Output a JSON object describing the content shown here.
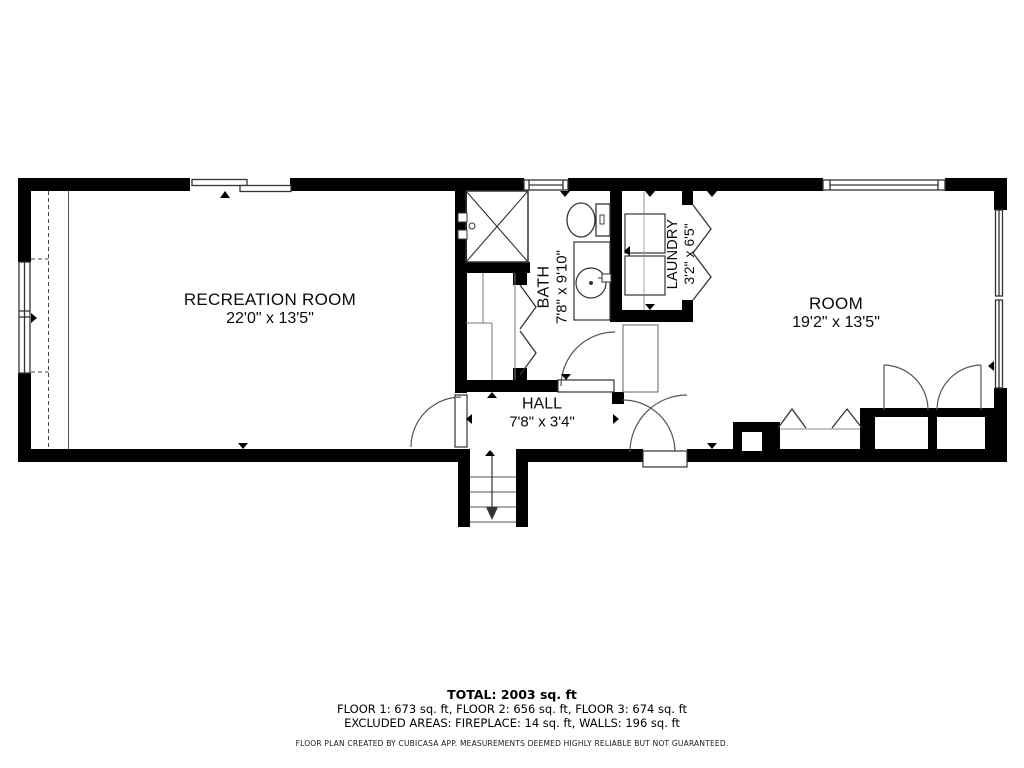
{
  "plan": {
    "rooms": [
      {
        "id": "recreation_room",
        "name": "RECREATION ROOM",
        "dims": "22'0\" x 13'5\""
      },
      {
        "id": "bath",
        "name": "BATH",
        "dims": "7'8\" x 9'10\""
      },
      {
        "id": "laundry",
        "name": "LAUNDRY",
        "dims": "3'2\" x 6'5\""
      },
      {
        "id": "room",
        "name": "ROOM",
        "dims": "19'2\" x 13'5\""
      },
      {
        "id": "hall",
        "name": "HALL",
        "dims": "7'8\" x 3'4\""
      }
    ],
    "features": [
      "stairs-down",
      "shower",
      "toilet",
      "sink-vanity",
      "washer",
      "dryer",
      "fireplace",
      "closets",
      "windows"
    ]
  },
  "summary": {
    "total": "TOTAL: 2003 sq. ft",
    "floors": "FLOOR 1: 673 sq. ft, FLOOR 2: 656 sq. ft, FLOOR 3: 674 sq. ft",
    "excluded": "EXCLUDED AREAS: FIREPLACE: 14 sq. ft, WALLS: 196 sq. ft",
    "disclaimer": "FLOOR PLAN CREATED BY CUBICASA APP. MEASUREMENTS DEEMED HIGHLY RELIABLE BUT NOT GUARANTEED."
  },
  "colors": {
    "wall": "#000000",
    "background": "#ffffff",
    "fixture_line": "#333333"
  }
}
